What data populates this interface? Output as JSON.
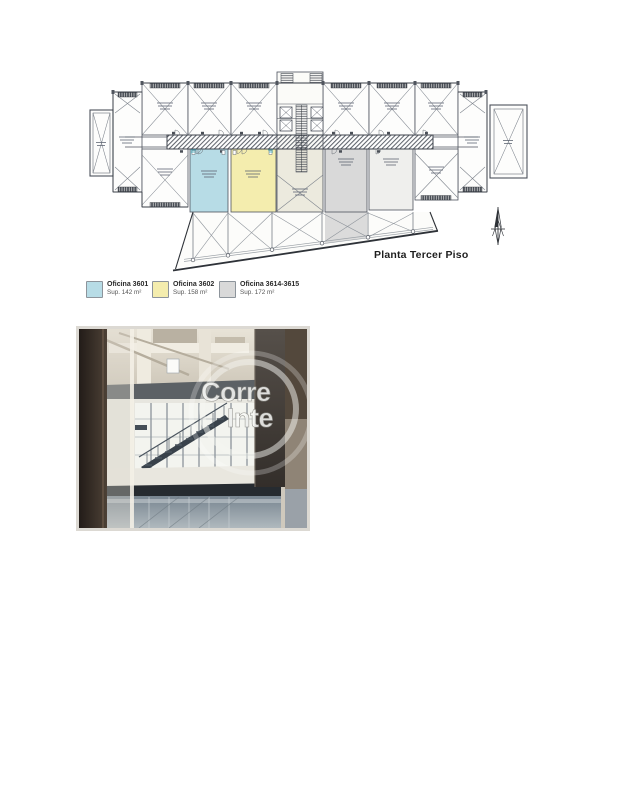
{
  "floor_plan": {
    "title": "Planta Tercer Piso",
    "colors": {
      "office_3601": "#b7dce6",
      "office_3602": "#f4edae",
      "office_3614": "#d9d9d9",
      "plan_line": "#4d525c"
    }
  },
  "legend": {
    "items": [
      {
        "label": "Oficina 3601",
        "area": "Sup. 142 m²",
        "color": "#b7dce6"
      },
      {
        "label": "Oficina 3602",
        "area": "Sup. 158 m²",
        "color": "#f4edae"
      },
      {
        "label": "Oficina 3614-3615",
        "area": "Sup. 172 m²",
        "color": "#d9d9d9"
      }
    ]
  },
  "photo": {
    "watermark": [
      "Corre",
      "Inte"
    ]
  }
}
